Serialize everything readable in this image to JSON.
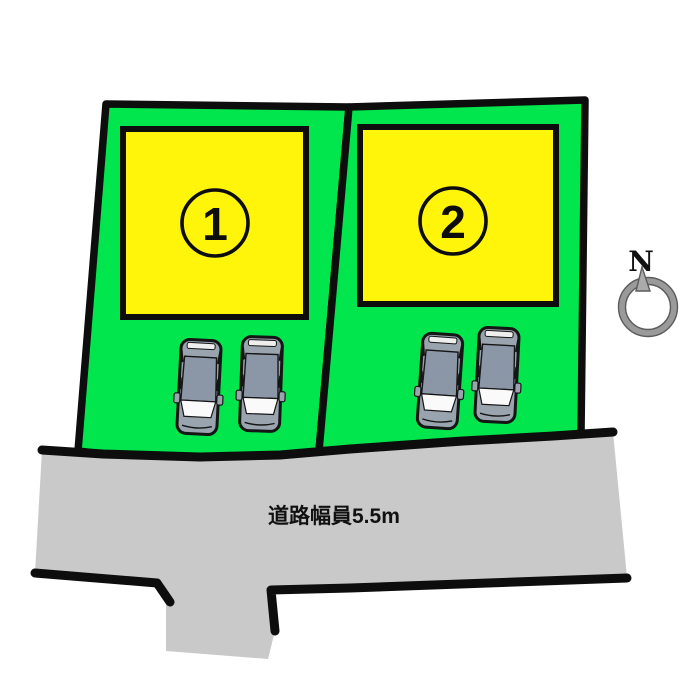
{
  "diagram": {
    "type": "real-estate-site-plan",
    "background": "#ffffff"
  },
  "colors": {
    "parcel": "#00e64c",
    "building": "#fff50a",
    "road": "#c9c9c9",
    "line": "#0d0d0d",
    "car_body": "#9aa4ae",
    "car_roof": "#8b97a7",
    "car_glass": "#fafafa",
    "compass_gray": "#9a9a9a",
    "compass_edge": "#5c5c5c"
  },
  "parcels": [
    {
      "number": "1"
    },
    {
      "number": "2"
    }
  ],
  "road": {
    "width_label": "道路幅員5.5m"
  },
  "compass": {
    "north_label": "N"
  }
}
